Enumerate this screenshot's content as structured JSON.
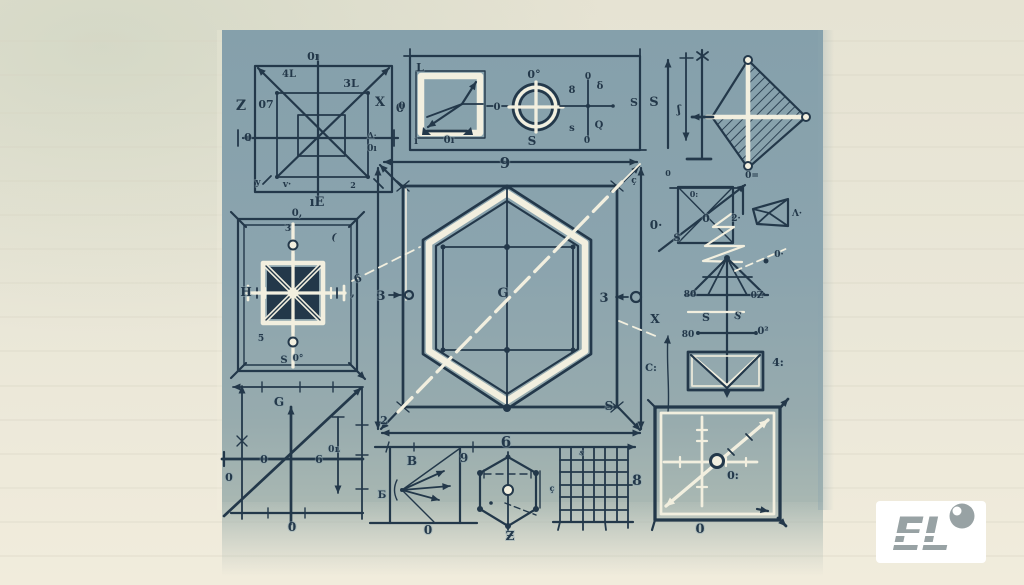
{
  "canvas": {
    "width": 1024,
    "height": 585
  },
  "colors": {
    "paperTop": "#e6e3d3",
    "paperMid": "#eae7d8",
    "paperBot": "#f1ecdc",
    "panelTop": "#85a0ab",
    "panel": "#8ba4ae",
    "panelLow": "#97abae",
    "panelBot": "#a8b7b2",
    "ink": "#23384a",
    "chalk": "#f2efdf",
    "rule": "#d6d3c2",
    "tint": "#c3cdb9",
    "logoGray": "#98a2a4",
    "logoBg": "#ffffff"
  },
  "logo": {
    "text": "EL"
  },
  "figures": [
    "nested-squares-figure",
    "square-circle-cross-figure",
    "dimension-kite-figure",
    "pinwheel-rect-figure",
    "hexagon-blueprint-figure",
    "x-square-figure",
    "tetrahedron-figure",
    "fan-triangle-figure",
    "v-rect-figure",
    "axes-graph-figure",
    "arrow-fan-figure",
    "dotted-hexagon-figure",
    "grid-figure",
    "diagonal-target-figure"
  ],
  "labels": {
    "nested_squares": [
      {
        "x": 313,
        "y": 60,
        "t": "0ı",
        "s": 11
      },
      {
        "x": 289,
        "y": 77,
        "t": "4L",
        "s": 10
      },
      {
        "x": 351,
        "y": 87,
        "t": "3L",
        "s": 11
      },
      {
        "x": 241,
        "y": 110,
        "t": "Z",
        "s": 14
      },
      {
        "x": 266,
        "y": 108,
        "t": "07",
        "s": 11
      },
      {
        "x": 380,
        "y": 106,
        "t": "X",
        "s": 13
      },
      {
        "x": 400,
        "y": 112,
        "t": "0",
        "s": 12
      },
      {
        "x": 248,
        "y": 141,
        "t": "0",
        "s": 11
      },
      {
        "x": 372,
        "y": 138,
        "t": "Δ·",
        "s": 8
      },
      {
        "x": 372,
        "y": 151,
        "t": "0ı",
        "s": 9
      },
      {
        "x": 258,
        "y": 185,
        "t": "y",
        "s": 9
      },
      {
        "x": 287,
        "y": 187,
        "t": "v·",
        "s": 9
      },
      {
        "x": 353,
        "y": 188,
        "t": "2",
        "s": 8
      },
      {
        "x": 317,
        "y": 206,
        "t": "ıE",
        "s": 13
      }
    ],
    "square_circle_cross": [
      {
        "x": 402,
        "y": 109,
        "t": "0",
        "s": 10
      },
      {
        "x": 420,
        "y": 71,
        "t": "L",
        "s": 11
      },
      {
        "x": 416,
        "y": 144,
        "t": "ı",
        "s": 10
      },
      {
        "x": 449,
        "y": 143,
        "t": "0ı",
        "s": 10
      },
      {
        "x": 497,
        "y": 110,
        "t": "0",
        "s": 10
      },
      {
        "x": 534,
        "y": 78,
        "t": "0°",
        "s": 11
      },
      {
        "x": 532,
        "y": 145,
        "t": "S",
        "s": 12
      },
      {
        "x": 588,
        "y": 79,
        "t": "0",
        "s": 9
      },
      {
        "x": 572,
        "y": 93,
        "t": "8",
        "s": 10
      },
      {
        "x": 600,
        "y": 89,
        "t": "δ",
        "s": 10
      },
      {
        "x": 572,
        "y": 131,
        "t": "s",
        "s": 10
      },
      {
        "x": 599,
        "y": 128,
        "t": "Q",
        "s": 10
      },
      {
        "x": 587,
        "y": 143,
        "t": "0",
        "s": 9
      },
      {
        "x": 634,
        "y": 106,
        "t": "S",
        "s": 11
      }
    ],
    "dimension_kite": [
      {
        "x": 654,
        "y": 106,
        "t": "S",
        "s": 13
      },
      {
        "x": 679,
        "y": 113,
        "t": "ʃ",
        "s": 11
      },
      {
        "x": 752,
        "y": 178,
        "t": "0=",
        "s": 9
      },
      {
        "x": 668,
        "y": 176,
        "t": "0",
        "s": 8
      }
    ],
    "hexagon_blueprint": [
      {
        "x": 505,
        "y": 168,
        "t": "9",
        "s": 15
      },
      {
        "x": 506,
        "y": 447,
        "t": "6",
        "s": 15
      },
      {
        "x": 384,
        "y": 424,
        "t": "2",
        "s": 11
      },
      {
        "x": 609,
        "y": 410,
        "t": "S",
        "s": 12
      },
      {
        "x": 381,
        "y": 300,
        "t": "3",
        "s": 13
      },
      {
        "x": 604,
        "y": 302,
        "t": "3",
        "s": 13
      },
      {
        "x": 503,
        "y": 297,
        "t": "G",
        "s": 13
      },
      {
        "x": 656,
        "y": 229,
        "t": "0·",
        "s": 12
      },
      {
        "x": 655,
        "y": 323,
        "t": "X",
        "s": 12
      },
      {
        "x": 651,
        "y": 371,
        "t": "C:",
        "s": 10
      },
      {
        "x": 359,
        "y": 282,
        "t": "6",
        "s": 11,
        "r": -20
      },
      {
        "x": 634,
        "y": 183,
        "t": "ç",
        "s": 9
      }
    ],
    "pinwheel_rect": [
      {
        "x": 297,
        "y": 216,
        "t": "0,",
        "s": 10
      },
      {
        "x": 288,
        "y": 231,
        "t": "3",
        "s": 9
      },
      {
        "x": 333,
        "y": 240,
        "t": "(",
        "s": 10,
        "r": 15
      },
      {
        "x": 353,
        "y": 296,
        "t": ",",
        "s": 10
      },
      {
        "x": 246,
        "y": 296,
        "t": "H",
        "s": 12
      },
      {
        "x": 261,
        "y": 341,
        "t": "5",
        "s": 9
      },
      {
        "x": 284,
        "y": 363,
        "t": "S",
        "s": 10
      },
      {
        "x": 298,
        "y": 361,
        "t": "0°",
        "s": 9
      }
    ],
    "right_column": [
      {
        "x": 694,
        "y": 197,
        "t": "0:",
        "s": 8
      },
      {
        "x": 706,
        "y": 222,
        "t": "0",
        "s": 11
      },
      {
        "x": 736,
        "y": 221,
        "t": "2·",
        "s": 9
      },
      {
        "x": 677,
        "y": 241,
        "t": "S",
        "s": 10
      },
      {
        "x": 797,
        "y": 216,
        "t": "Λ·",
        "s": 9
      },
      {
        "x": 779,
        "y": 257,
        "t": "0·",
        "s": 9
      },
      {
        "x": 690,
        "y": 297,
        "t": "80",
        "s": 9
      },
      {
        "x": 757,
        "y": 298,
        "t": "0Z",
        "s": 9
      },
      {
        "x": 706,
        "y": 321,
        "t": "S",
        "s": 11
      },
      {
        "x": 737,
        "y": 319,
        "t": "S",
        "s": 10,
        "r": 15
      },
      {
        "x": 688,
        "y": 337,
        "t": "80",
        "s": 9
      },
      {
        "x": 763,
        "y": 334,
        "t": "0²",
        "s": 10
      },
      {
        "x": 778,
        "y": 366,
        "t": "4:",
        "s": 11
      }
    ],
    "axes_graph": [
      {
        "x": 279,
        "y": 406,
        "t": "G",
        "s": 12
      },
      {
        "x": 264,
        "y": 463,
        "t": "0",
        "s": 11
      },
      {
        "x": 319,
        "y": 463,
        "t": "6",
        "s": 11
      },
      {
        "x": 334,
        "y": 452,
        "t": "0ʟ",
        "s": 9
      },
      {
        "x": 229,
        "y": 481,
        "t": "0",
        "s": 11
      },
      {
        "x": 292,
        "y": 531,
        "t": "0",
        "s": 12
      }
    ],
    "arrow_fan": [
      {
        "x": 412,
        "y": 465,
        "t": "B",
        "s": 12
      },
      {
        "x": 464,
        "y": 462,
        "t": "9",
        "s": 12
      },
      {
        "x": 382,
        "y": 498,
        "t": "Б",
        "s": 10
      },
      {
        "x": 428,
        "y": 534,
        "t": "0",
        "s": 12
      }
    ],
    "dotted_hexagon": [
      {
        "x": 510,
        "y": 540,
        "t": "Ƶ",
        "s": 12
      },
      {
        "x": 552,
        "y": 491,
        "t": "ç",
        "s": 8
      }
    ],
    "grid": [
      {
        "x": 637,
        "y": 485,
        "t": "8",
        "s": 14
      },
      {
        "x": 581,
        "y": 455,
        "t": "s",
        "s": 8,
        "r": 20
      }
    ],
    "diagonal_target": [
      {
        "x": 733,
        "y": 479,
        "t": "0:",
        "s": 11
      },
      {
        "x": 700,
        "y": 533,
        "t": "0",
        "s": 13
      }
    ]
  }
}
